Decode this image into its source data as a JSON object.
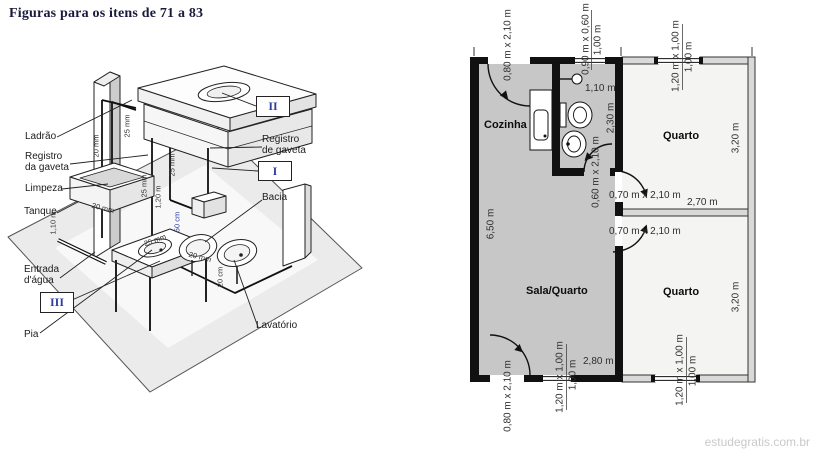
{
  "page": {
    "title": "Figuras para os itens de 71 a 83",
    "watermark": "estudegratis.com.br"
  },
  "iso": {
    "labels": {
      "ladrao": "Ladrão",
      "registro_da": "Registro\nda gaveta",
      "limpeza": "Limpeza",
      "tanque": "Tanque",
      "entrada": "Entrada\nd'água",
      "pia": "Pia",
      "registro_de": "Registro\nde gaveta",
      "bacia": "Bacia",
      "lavatorio": "Lavatório"
    },
    "numerals": {
      "i": "I",
      "ii": "II",
      "iii": "III"
    },
    "pipe_labels": {
      "wall_riser": "20 mm",
      "overflow": "25 mm",
      "riser": "25 mm",
      "riser_len": "1,20 m",
      "bacia_feed": "25 mm",
      "bacia_height": "50 cm",
      "entrada_height": "1,10 m",
      "tanque_branch": "20 mm",
      "floor_run": "25 mm",
      "lavatorio_branch": "20 mm",
      "lavatorio_height": "20 cm"
    }
  },
  "plan": {
    "rooms": {
      "cozinha": "Cozinha",
      "quarto_top": "Quarto",
      "sala": "Sala/Quarto",
      "quarto_bottom": "Quarto"
    },
    "dims": {
      "door_top": "0,80 m  x  2,10 m",
      "window_bath": "0,90 m x 0,60 m",
      "sill_bath": "1,00 m",
      "width_bath": "1,10 m",
      "height_bath": "2,30 m",
      "door_bath": "0,60 m  x  2,10 m",
      "window_q_top": "1,20 m x 1,00 m",
      "sill_q_top": "1,00 m",
      "depth_q_top": "3,20 m",
      "door_q_top": "0,70 m x 2,10 m",
      "hall_width": "2,70 m",
      "door_q_bottom": "0,70 m x 2,10 m",
      "height_left": "6,50 m",
      "door_bottom": "0,80 m  x  2,10 m",
      "window_sala": "1,20 m x 1,00 m",
      "sill_sala": "1,00 m",
      "width_sala": "2,80 m",
      "depth_q_bottom": "3,20 m",
      "window_q_bottom": "1,20 m x 1,00 m",
      "sill_q_bottom": "1,00 m"
    }
  }
}
